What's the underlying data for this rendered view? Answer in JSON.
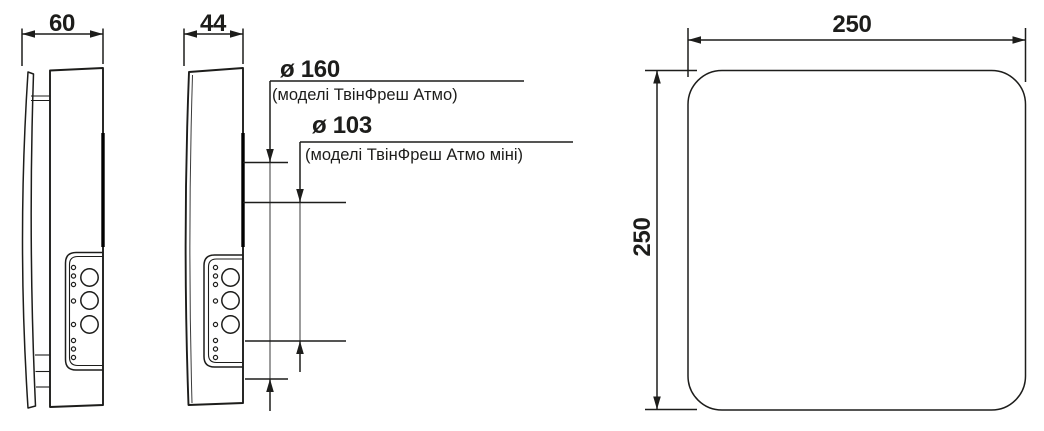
{
  "labels": {
    "depth_left": "60",
    "depth_middle": "44",
    "front_width": "250",
    "front_height": "250",
    "dia_large": "ø 160",
    "dia_large_note": "(моделі ТвінФреш Атмо)",
    "dia_small": "ø 103",
    "dia_small_note": "(моделі ТвінФреш Атмо міні)"
  },
  "colors": {
    "line": "#1d1d1b",
    "background": "#ffffff"
  }
}
